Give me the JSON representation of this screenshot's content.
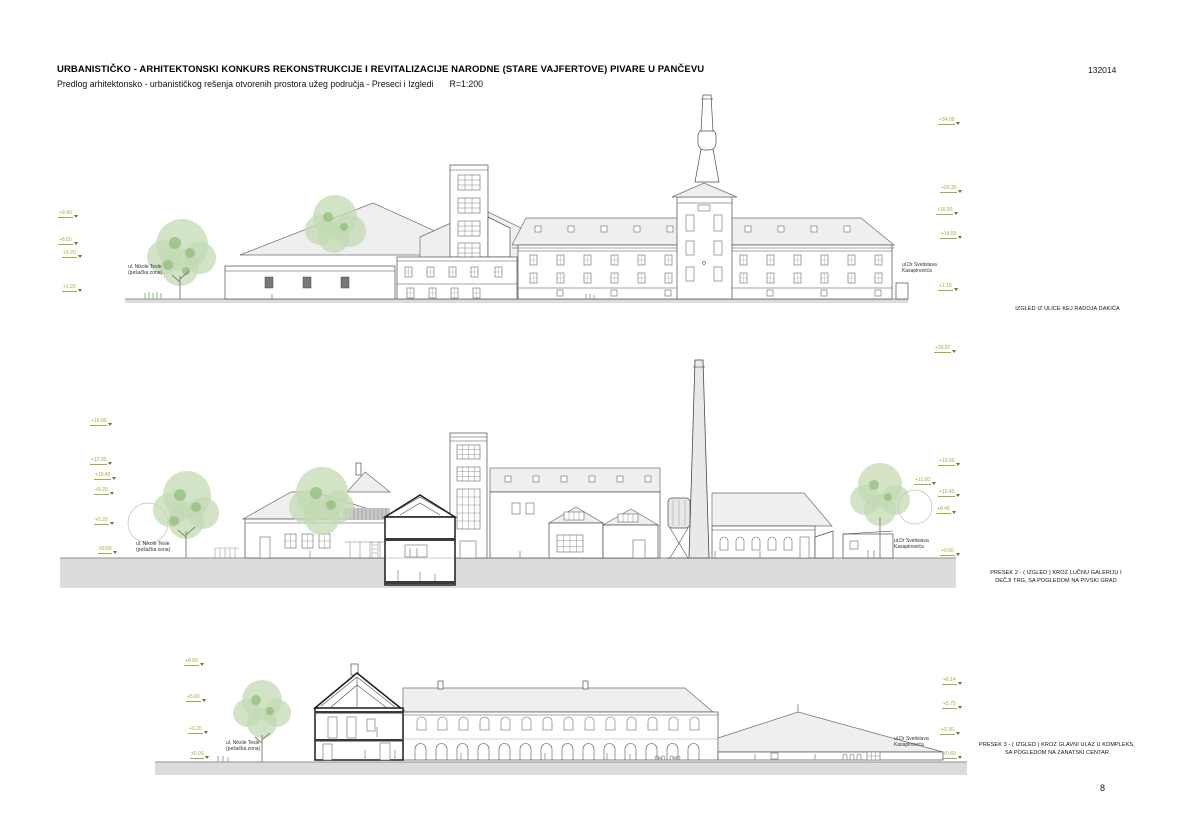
{
  "header": {
    "title": "URBANISTIČKO - ARHITEKTONSKI KONKURS REKONSTRUKCIJE I REVITALIZACIJE NARODNE (STARE VAJFERTOVE) PIVARE U PANČEVU",
    "subtitle": "Predlog arhitektonsko - urbanističkog rešenja otvorenih prostora užeg područja - Preseci i Izgledi",
    "scale": "R=1:200",
    "code": "132014"
  },
  "page_number": "8",
  "colors": {
    "level_marker": "#a9a93f",
    "tree_green": "#9cc08a",
    "roof_gray": "#efefef",
    "ground_gray": "#dcdcdc"
  },
  "drawings": [
    {
      "name": "izgled-kej-radoja-dakica",
      "caption_line1": "IZGLED IZ ULICE KEJ RADOJA DAKIĆA",
      "street_left_line1": "ul. Nikole Tesle",
      "street_left_line2": "(pešačka zona)",
      "street_right_line1": "ul.Dr Svetislava",
      "street_right_line2": "Kasapinovića",
      "levels_left": [
        "+9.40",
        "+6.50",
        "+5.20",
        "+1.20"
      ],
      "levels_right": [
        "+34.09",
        "+20.30",
        "+16.50",
        "+14.50",
        "+1.10"
      ]
    },
    {
      "name": "presek-2",
      "caption_line1": "PRESEK 2 - ( IZGLED ) KROZ LUČNU GALERIJU I",
      "caption_line2": "DEČJI TRG, SA POGLEDOM NA PIVSKI GRAD",
      "street_left_line1": "ul. Nikole Tesle",
      "street_left_line2": "(pešačka zona)",
      "street_right_line1": "ul.Dr Svetislava",
      "street_right_line2": "Kasapinovića",
      "levels_left": [
        "+16.00",
        "+12.00",
        "+10.40",
        "+9.20",
        "+5.20",
        "±0.00"
      ],
      "levels_right": [
        "+30.87",
        "+13.00",
        "+11.60",
        "+10.40",
        "+8.40",
        "+0.60"
      ]
    },
    {
      "name": "presek-3",
      "caption_line1": "PRESEK 3 - ( IZGLED ) KROZ GLAVNI ULAZ U KOMPLEKS,",
      "caption_line2": "SA POGLEDOM NA ZANATSKI CENTAR",
      "street_left_line1": "ul. Nikole Tesle",
      "street_left_line2": "(pešačka zona)",
      "street_right_line1": "ul.Dr Svetislava",
      "street_right_line2": "Kasapinovića",
      "levels_left": [
        "+8.60",
        "+5.60",
        "+3.20",
        "±0.00"
      ],
      "levels_right": [
        "+8.14",
        "+5.75",
        "+3.30",
        "+0.60"
      ]
    }
  ]
}
